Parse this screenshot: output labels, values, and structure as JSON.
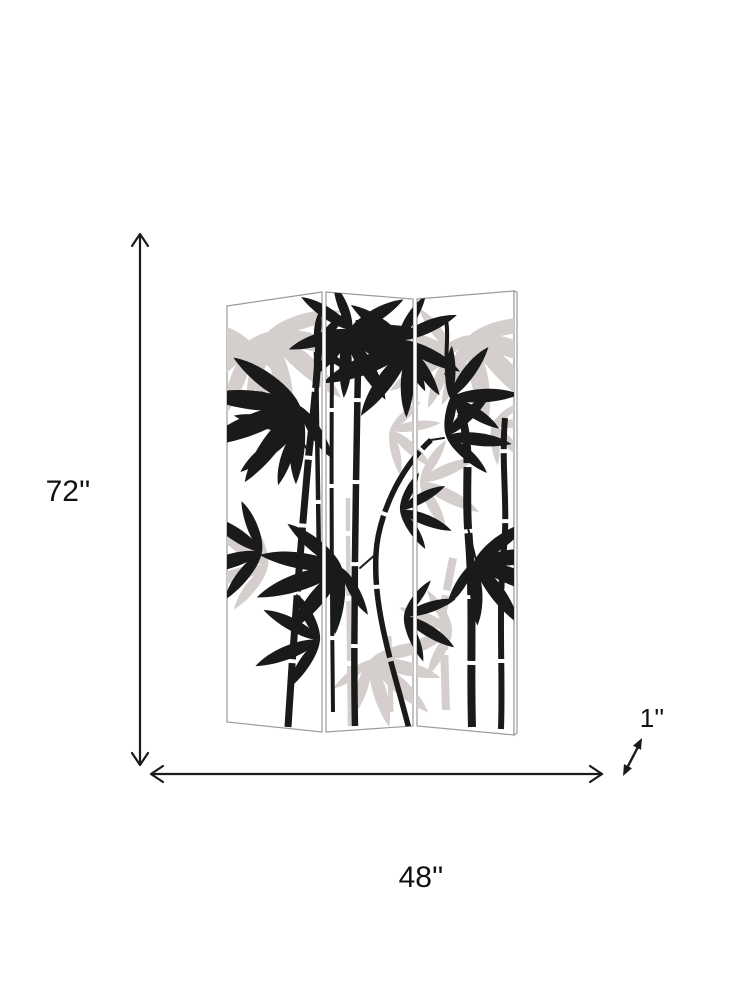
{
  "diagram": {
    "type": "product-dimensions",
    "product": {
      "name": "3-panel folding screen room divider with bamboo print",
      "panel_count": 3,
      "artwork": "bamboo"
    },
    "dimensions": {
      "height": {
        "label": "72''"
      },
      "width": {
        "label": "48''"
      },
      "depth": {
        "label": "1''"
      }
    },
    "colors": {
      "line": "#1a1a1a",
      "bamboo_black": "#1a1a1a",
      "bamboo_gray": "#d4cecd",
      "panel_outline": "#9b9b9b",
      "background": "#ffffff"
    },
    "icons": {
      "height_arrow": "vertical-double-arrow-icon",
      "width_arrow": "horizontal-double-arrow-icon",
      "depth_arrow": "diagonal-double-arrow-icon"
    }
  }
}
